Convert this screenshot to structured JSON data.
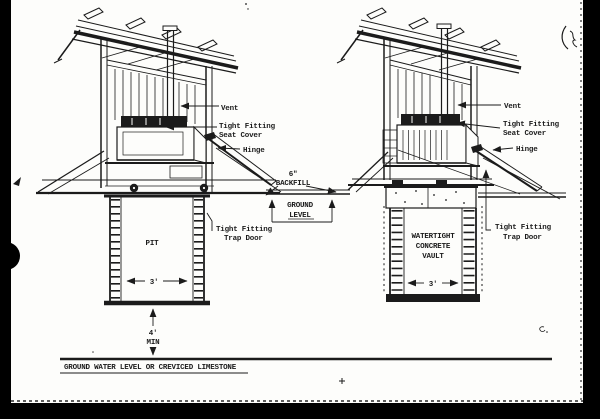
{
  "page": {
    "background": "#fdfdfb",
    "ink_color": "#1b1b1b",
    "scan_border_color": "#000000"
  },
  "diagram": {
    "left_privy": {
      "vent_label": "Vent",
      "seat_cover_label_line1": "Tight Fitting",
      "seat_cover_label_line2": "Seat Cover",
      "hinge_label": "Hinge",
      "trap_door_label_line1": "Tight Fitting",
      "trap_door_label_line2": "Trap Door",
      "chamber_label": "PIT",
      "chamber_width": "3'"
    },
    "center": {
      "backfill_label_line1": "6\"",
      "backfill_label_line2": "BACKFILL",
      "ground_level_label_line1": "GROUND",
      "ground_level_label_line2": "LEVEL"
    },
    "right_privy": {
      "vent_label": "Vent",
      "seat_cover_label_line1": "Tight Fitting",
      "seat_cover_label_line2": "Seat Cover",
      "hinge_label": "Hinge",
      "trap_door_label_line1": "Tight Fitting",
      "trap_door_label_line2": "Trap Door",
      "chamber_label_line1": "WATERTIGHT",
      "chamber_label_line2": "CONCRETE",
      "chamber_label_line3": "VAULT",
      "chamber_width": "3'"
    },
    "depth": {
      "min_depth_line1": "4'",
      "min_depth_line2": "MIN"
    },
    "ground_water_label": "GROUND WATER LEVEL OR CREVICED LIMESTONE"
  }
}
